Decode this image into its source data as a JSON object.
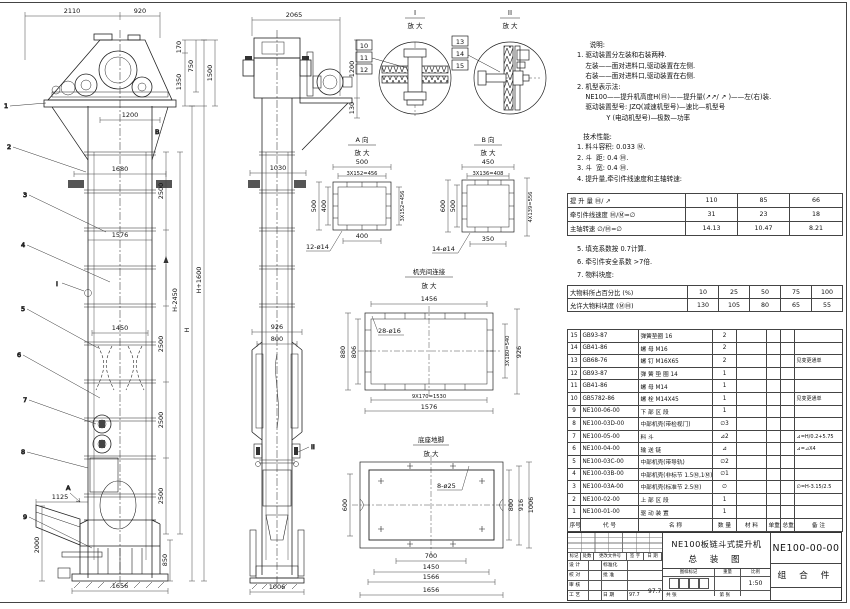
{
  "drawing": {
    "title_line1": "NE100板链斗式提升机",
    "title_line2": "总  装  图",
    "number": "NE100-00-00",
    "kind": "组 合 件",
    "scale": "1:50",
    "date": "97.7"
  },
  "notes1": [
    "      说明:",
    "1. 驱动装置分左装和右装两种.",
    "    左装——面对进料口,驱动装置在左侧.",
    "    右装——面对进料口,驱动装置在右侧.",
    "2. 机型表示法:",
    "    NE100——提升机高度H(Ⓜ)——提升量(↗↗/ ↗ )——左(右)装.",
    "    驱动装置型号: JZQ(减速机型号)—速比—机型号",
    "              Y (电动机型号)—极数—功率"
  ],
  "notes2": [
    "   技术性能:",
    "1. 料斗容积: 0.033 Ⓜ.",
    "2. 斗  距: 0.4 Ⓜ.",
    "3. 斗  宽: 0.4 Ⓜ.",
    "4. 提升量,牵引件线速度和主轴转速:"
  ],
  "notes3": [
    "5. 填充系数按 0.7计算.",
    "6. 牵引件安全系数 >7倍.",
    "7. 物料块度:"
  ],
  "capacity": {
    "rows": [
      {
        "label": "提 升 量   Ⓜ/ ↗",
        "v1": "110",
        "v2": "85",
        "v3": "66"
      },
      {
        "label": "牵引件线速度  Ⓜ/Ⓜ=∅",
        "v1": "31",
        "v2": "23",
        "v3": "18"
      },
      {
        "label": "主轴转速  ∅/Ⓜ=∅",
        "v1": "14.13",
        "v2": "10.47",
        "v3": "8.21"
      }
    ]
  },
  "lump": {
    "row1_label": "大物料所占百分比  (%)",
    "row1": [
      "10",
      "25",
      "50",
      "75",
      "100"
    ],
    "row2_label": "允许大物料块度  (ⓂⓂ)",
    "row2": [
      "130",
      "105",
      "80",
      "65",
      "55"
    ]
  },
  "parts": {
    "h": {
      "no": "序号",
      "code": "代  号",
      "name": "名  称",
      "qty": "数 量",
      "mat": "材  料",
      "uw": "单重",
      "tw": "总重",
      "remark": "备  注"
    },
    "rows": [
      {
        "no": "15",
        "code": "GB93-87",
        "name": "弹簧垫圈  16",
        "qty": "2",
        "mat": "",
        "uw": "",
        "tw": "",
        "remark": ""
      },
      {
        "no": "14",
        "code": "GB41-86",
        "name": "螺 母  M16",
        "qty": "2",
        "mat": "",
        "uw": "",
        "tw": "",
        "remark": ""
      },
      {
        "no": "13",
        "code": "GB68-76",
        "name": "螺 钉  M16X65",
        "qty": "2",
        "mat": "",
        "uw": "",
        "tw": "",
        "remark": "见变更通单"
      },
      {
        "no": "12",
        "code": "GB93-87",
        "name": "弹 簧 垫 圈  14",
        "qty": "1",
        "mat": "",
        "uw": "",
        "tw": "",
        "remark": ""
      },
      {
        "no": "11",
        "code": "GB41-86",
        "name": "螺 母  M14",
        "qty": "1",
        "mat": "",
        "uw": "",
        "tw": "",
        "remark": ""
      },
      {
        "no": "10",
        "code": "GB5782-86",
        "name": "螺 栓  M14X45",
        "qty": "1",
        "mat": "",
        "uw": "",
        "tw": "",
        "remark": "见变更通单"
      },
      {
        "no": "9",
        "code": "NE100-06-00",
        "name": "下 部 区 段",
        "qty": "1",
        "mat": "",
        "uw": "",
        "tw": "",
        "remark": ""
      },
      {
        "no": "8",
        "code": "NE100-03D-00",
        "name": "中部机壳(带检视门)",
        "qty": "∅3",
        "mat": "",
        "uw": "",
        "tw": "",
        "remark": ""
      },
      {
        "no": "7",
        "code": "NE100-05-00",
        "name": "料 斗",
        "qty": "⊿2",
        "mat": "",
        "uw": "",
        "tw": "",
        "remark": "⊿=H/0.2+5.75"
      },
      {
        "no": "6",
        "code": "NE100-04-00",
        "name": "输 送 链",
        "qty": "⊿",
        "mat": "",
        "uw": "",
        "tw": "",
        "remark": "⊿=⊿X4"
      },
      {
        "no": "5",
        "code": "NE100-03C-00",
        "name": "中部机壳(带导轨)",
        "qty": "∅2",
        "mat": "",
        "uw": "",
        "tw": "",
        "remark": ""
      },
      {
        "no": "4",
        "code": "NE100-03B-00",
        "name": "中部机壳(非标节 1.5Ⓜ,1Ⓜ)",
        "qty": "∅1",
        "mat": "",
        "uw": "",
        "tw": "",
        "remark": ""
      },
      {
        "no": "3",
        "code": "NE100-03A-00",
        "name": "中部机壳(标准节 2.5Ⓜ)",
        "qty": "∅",
        "mat": "",
        "uw": "",
        "tw": "",
        "remark": "∅=H-3.15/2.5"
      },
      {
        "no": "2",
        "code": "NE100-02-00",
        "name": "上 部 区 段",
        "qty": "1",
        "mat": "",
        "uw": "",
        "tw": "",
        "remark": ""
      },
      {
        "no": "1",
        "code": "NE100-01-00",
        "name": "驱 动 装 置",
        "qty": "1",
        "mat": "",
        "uw": "",
        "tw": "",
        "remark": ""
      }
    ]
  },
  "titleblock": {
    "rev_headers": [
      "标记",
      "处数",
      "更改文件号",
      "签 字",
      "日 期"
    ],
    "sig_rows": [
      {
        "a": "设 计",
        "b": "标准化",
        "c": ""
      },
      {
        "a": "校 对",
        "b": "批 准",
        "c": ""
      },
      {
        "a": "审 核",
        "b": "",
        "c": ""
      },
      {
        "a": "工 艺",
        "b": "日 期",
        "c": "97.7"
      }
    ],
    "stamp": "图样标记",
    "weight": "重量",
    "scale_label": "比例",
    "scale": "1:50",
    "sheets": "共  张",
    "sheet": "第  张"
  },
  "dims": {
    "v1": {
      "d2110": "2110",
      "d920": "920",
      "d170": "170",
      "d750": "750",
      "d1350": "1350",
      "d1500": "1500",
      "d1200": "1200",
      "d1680": "1680",
      "d1576": "1576",
      "d1450": "1450",
      "seg1": "2500",
      "seg2": "2500",
      "seg3": "2500",
      "seg4": "2500",
      "dHm": "H-2450",
      "dH": "H",
      "dHp": "H+1600",
      "d1125": "1125",
      "d2000": "2000",
      "d850": "850",
      "d1656": "1656"
    },
    "v2": {
      "d2065": "2065",
      "d1200": "1200",
      "d130": "130",
      "d1030": "1030",
      "d926": "926",
      "d800": "800",
      "d1006": "1006"
    }
  },
  "callouts": {
    "c1": "1",
    "c2": "2",
    "c3": "3",
    "c4": "4",
    "c5": "5",
    "c6": "6",
    "c7": "7",
    "c8": "8",
    "c9": "9",
    "c10": "10",
    "c11": "11",
    "c12": "12",
    "c13": "13",
    "c14": "14",
    "c15": "15",
    "mA": "A",
    "mB": "B",
    "mI": "I",
    "mII": "II"
  },
  "details": {
    "dI": {
      "name": "I",
      "zoom": "放 大"
    },
    "dII": {
      "name": "II",
      "zoom": "放 大"
    },
    "dA": {
      "name": "A 向",
      "zoom": "放 大",
      "top": "500",
      "pitch": "3X152=456",
      "left": "500",
      "left_in": "400",
      "right": "3X152=456",
      "bottom": "400",
      "holes": "12-ø14"
    },
    "dB": {
      "name": "B 向",
      "zoom": "放 大",
      "top": "450",
      "pitch": "3X136=408",
      "left": "600",
      "left_in": "500",
      "right": "4X139=556",
      "bottom": "350",
      "holes": "14-ø14"
    },
    "dC": {
      "name": "机壳间连接",
      "zoom": "放 大",
      "top": "1456",
      "holes": "28-ø16",
      "left": "880",
      "left_in": "806",
      "right_pitch": "3X180=540",
      "right": "926",
      "bottom_pitch": "9X170=1530",
      "bottom": "1576"
    },
    "dD": {
      "name": "底座地脚",
      "zoom": "放 大",
      "holes": "8-ø25",
      "left": "600",
      "r1": "800",
      "r2": "916",
      "r3": "1006",
      "b1": "700",
      "b2": "1450",
      "b3": "1566",
      "b4": "1656"
    }
  }
}
